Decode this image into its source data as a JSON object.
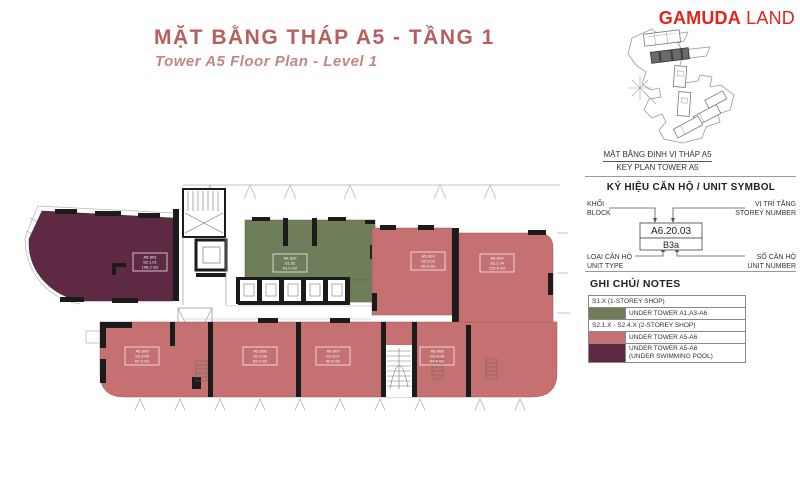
{
  "header": {
    "title": "MẶT BẰNG THÁP A5 - TẦNG 1",
    "subtitle": "Tower A5 Floor Plan - Level 1"
  },
  "brand": {
    "gamuda": "GAMUDA",
    "land": "LAND"
  },
  "keyplan": {
    "caption_vi": "MẶT BẰNG ĐỊNH VỊ THÁP A5",
    "caption_en": "KEY PLAN TOWER A5"
  },
  "unit_symbol": {
    "title": "KÝ HIỆU CĂN HỘ / UNIT SYMBOL",
    "block_vi": "KHỐI",
    "block_en": "BLOCK",
    "storey_vi": "VỊ TRÍ TẦNG",
    "storey_en": "STOREY NUMBER",
    "type_vi": "LOẠI CĂN HỘ",
    "type_en": "UNIT TYPE",
    "number_vi": "SỐ CĂN HỘ",
    "number_en": "UNIT NUMBER",
    "example_code": "A6.20.03",
    "example_type": "B3a"
  },
  "notes": {
    "title": "GHI CHÚ/ NOTES",
    "row1": "S1.X (1-STOREY SHOP)",
    "row2": "UNDER TOWER A1,A3-A6",
    "row3": "S2.1.X - S2.4.X (2-STOREY SHOP)",
    "row4": "UNDER TOWER A5-A6",
    "row5a": "UNDER TOWER A5-A6",
    "row5b": "(UNDER SWIMMING POOL)"
  },
  "colors": {
    "shop_1storey": "#6e7e5b",
    "shop_2storey": "#c67171",
    "under_pool": "#5e2942",
    "brand_red": "#e1251b",
    "title_red": "#b55f5f",
    "wall": "#1b1b1b"
  },
  "plan": {
    "units": {
      "pool": {
        "l1": "A5.S01",
        "l2": "S2.1.01",
        "l3": "198.2 m2"
      },
      "green": {
        "l1": "A5.S02",
        "l2": "S1.02",
        "l3": "91.0 m2"
      },
      "tra": {
        "l1": "A5.S03",
        "l2": "S2.2.03",
        "l3": "95.8 m2"
      },
      "trb": {
        "l1": "A5.S04",
        "l2": "S2.2.04",
        "l3": "120.5 m2"
      },
      "b1": {
        "l1": "A5.S05",
        "l2": "S2.3.05",
        "l3": "87.3 m2"
      },
      "b2": {
        "l1": "A5.S06",
        "l2": "S2.3.06",
        "l3": "92.0 m2"
      },
      "b3": {
        "l1": "A5.S07",
        "l2": "S2.3.07",
        "l3": "90.6 m2"
      },
      "b4": {
        "l1": "A5.S08",
        "l2": "S2.4.08",
        "l3": "93.4 m2"
      }
    }
  }
}
